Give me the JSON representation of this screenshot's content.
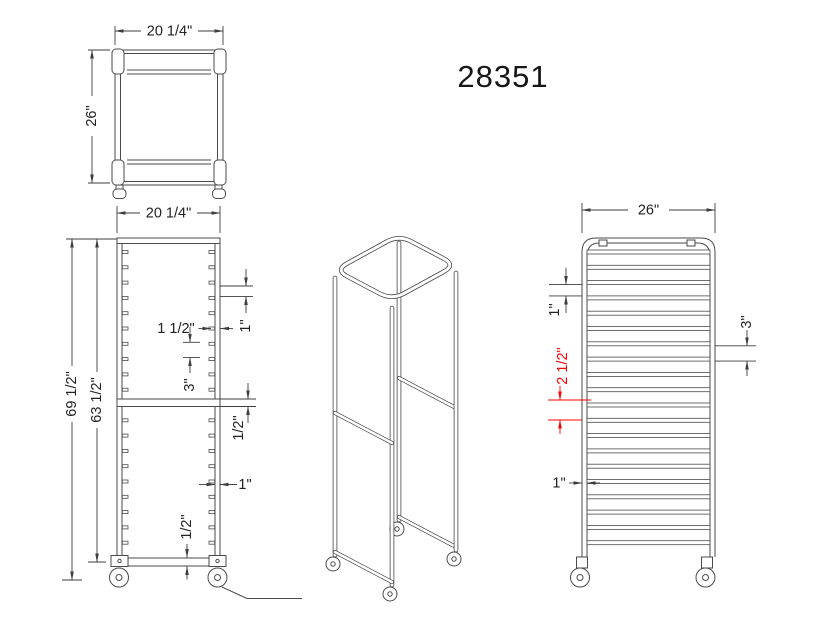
{
  "title": "28351",
  "colors": {
    "line": "#4a4a4a",
    "dimension": "#3d3d3d",
    "highlight": "#ff0000",
    "background": "#ffffff"
  },
  "top_view": {
    "width": "20 1/4\"",
    "depth": "26\""
  },
  "front_view": {
    "width": "20 1/4\"",
    "overall_height": "69 1/2\"",
    "frame_height": "63 1/2\"",
    "slide_size": "1 1/2\"",
    "slide_gap": "1\"",
    "slide_pitch": "3\"",
    "mid_rail_thickness": "1/2\"",
    "post_width": "1\"",
    "bottom_rail_thickness": "1/2\""
  },
  "side_view": {
    "width": "26\"",
    "slide_gap": "1\"",
    "slide_pitch": "3\"",
    "mid_offset": "2 1/2\"",
    "post_width": "1\""
  }
}
